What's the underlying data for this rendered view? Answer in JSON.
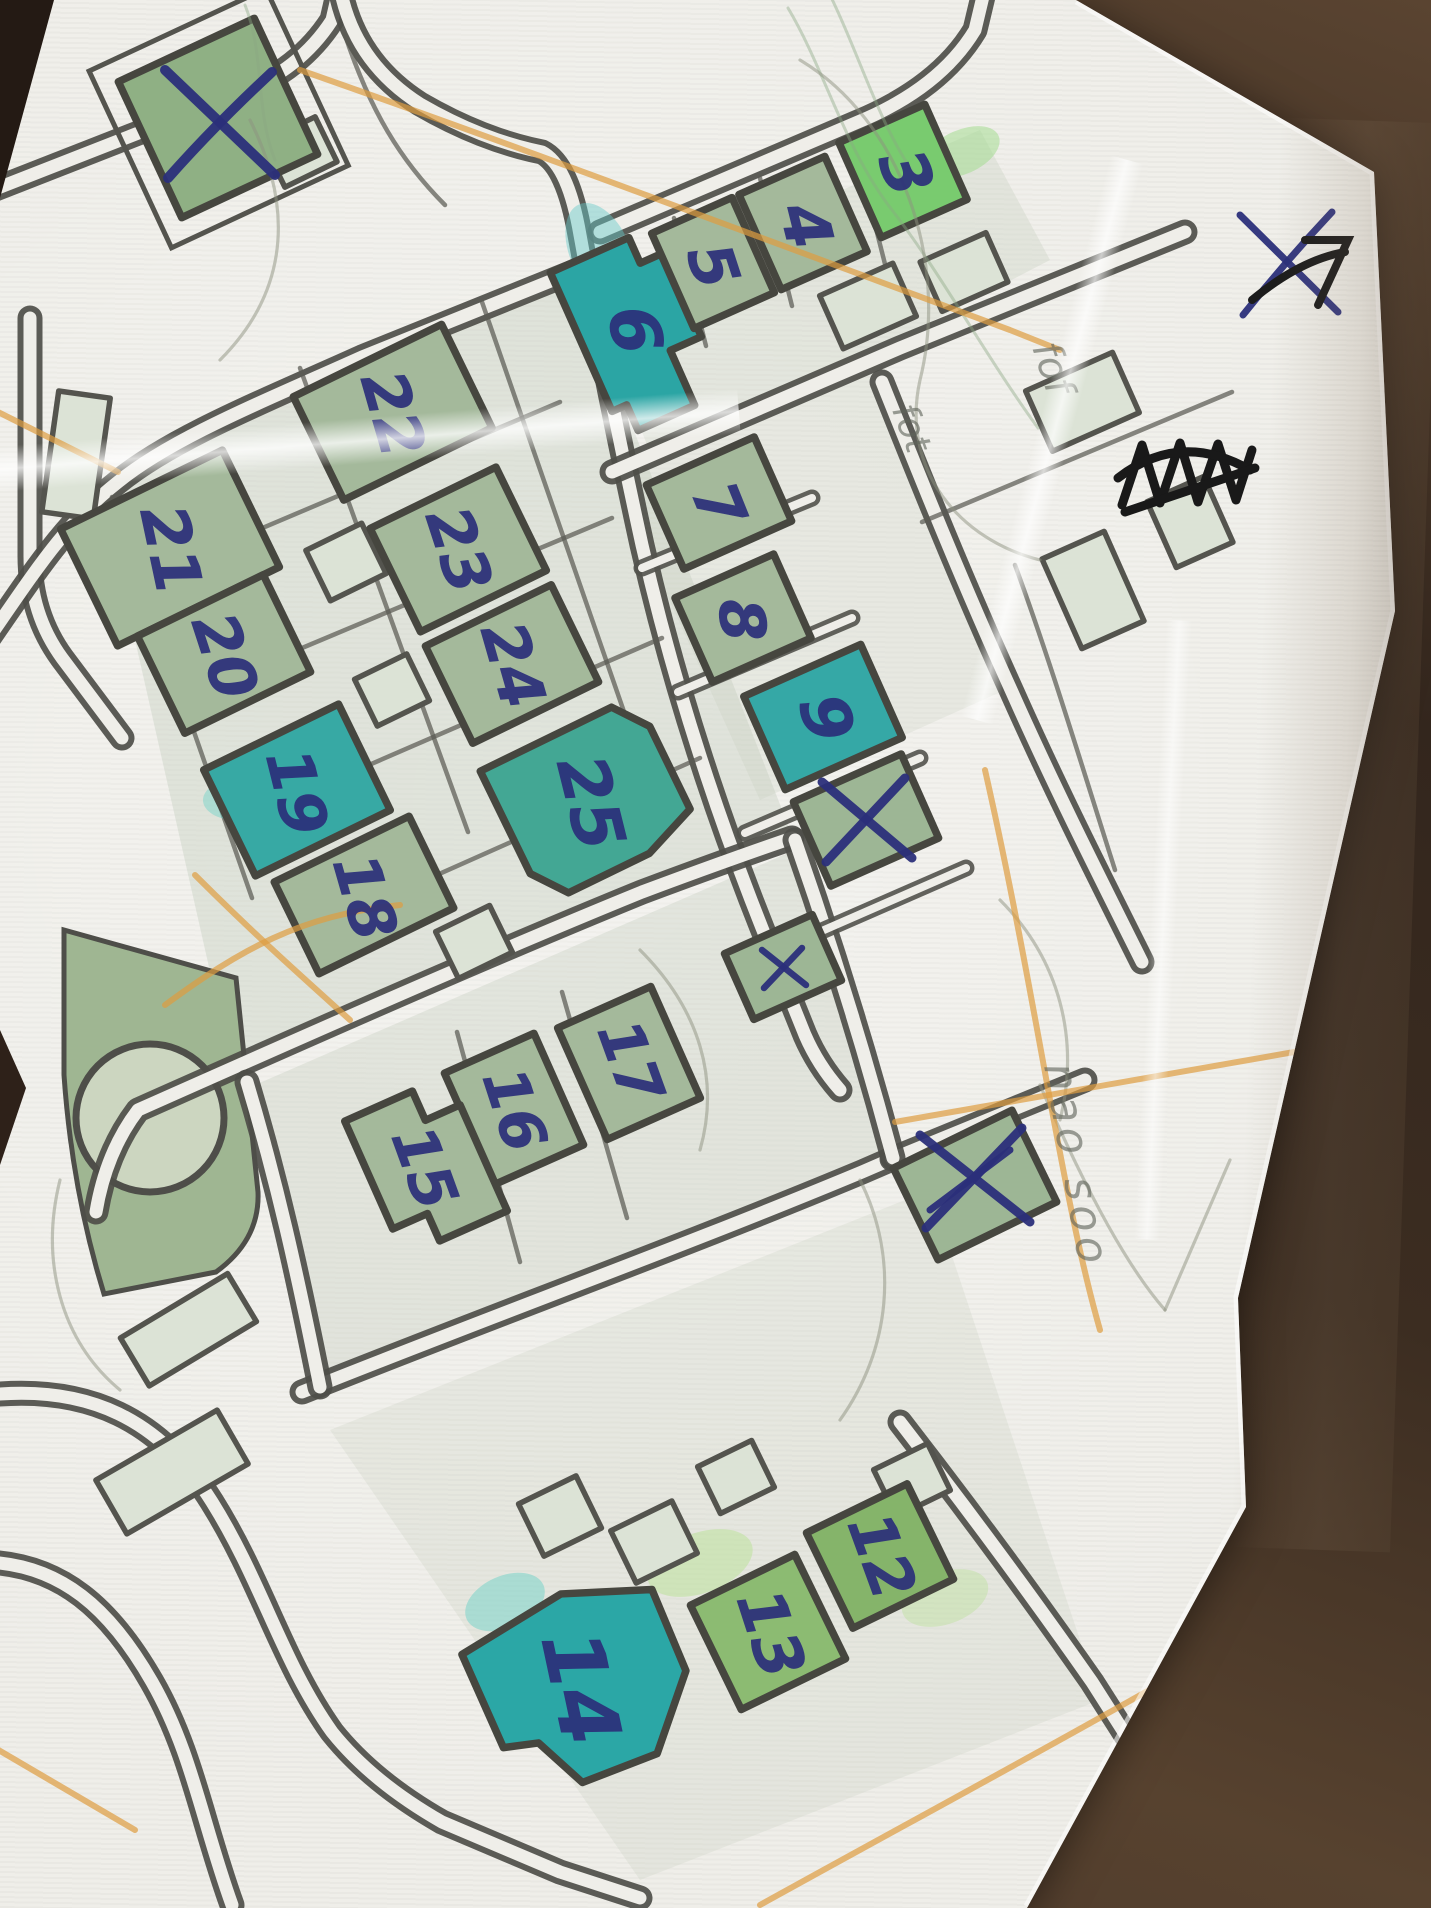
{
  "scene": {
    "type": "photographed paper street map with handwritten annotations",
    "surface": "dark brown table",
    "map_style": "orienteering control-picking map"
  },
  "colors": {
    "paper": "#efeee9",
    "ink_blue": "#2b2f7a",
    "road_gray": "#4e4e49",
    "building_green": "#a4b99b",
    "building_bright_green": "#79cb6f",
    "building_teal": "#2ba5a4",
    "pencil_orange": "#de9c40",
    "marker_black": "#1c1c1c"
  },
  "buildings": [
    {
      "label": "3",
      "highlight": "bright-green"
    },
    {
      "label": "4",
      "highlight": "green"
    },
    {
      "label": "5",
      "highlight": "green"
    },
    {
      "label": "6",
      "highlight": "teal"
    },
    {
      "label": "7",
      "highlight": "green"
    },
    {
      "label": "8",
      "highlight": "green"
    },
    {
      "label": "9",
      "highlight": "teal"
    },
    {
      "label": "12",
      "highlight": "green"
    },
    {
      "label": "13",
      "highlight": "green"
    },
    {
      "label": "14",
      "highlight": "teal"
    },
    {
      "label": "15",
      "highlight": "green"
    },
    {
      "label": "16",
      "highlight": "green"
    },
    {
      "label": "17",
      "highlight": "green"
    },
    {
      "label": "18",
      "highlight": "green"
    },
    {
      "label": "19",
      "highlight": "teal"
    },
    {
      "label": "20",
      "highlight": "green"
    },
    {
      "label": "21",
      "highlight": "green"
    },
    {
      "label": "22",
      "highlight": "green"
    },
    {
      "label": "23",
      "highlight": "green"
    },
    {
      "label": "24",
      "highlight": "green"
    },
    {
      "label": "25",
      "highlight": "teal-green"
    }
  ],
  "cross_marks": {
    "count": 5,
    "glyph": "X"
  },
  "pencil_notes": [
    {
      "text": "fof"
    },
    {
      "text": "fot"
    },
    {
      "text": "nao soo"
    }
  ]
}
